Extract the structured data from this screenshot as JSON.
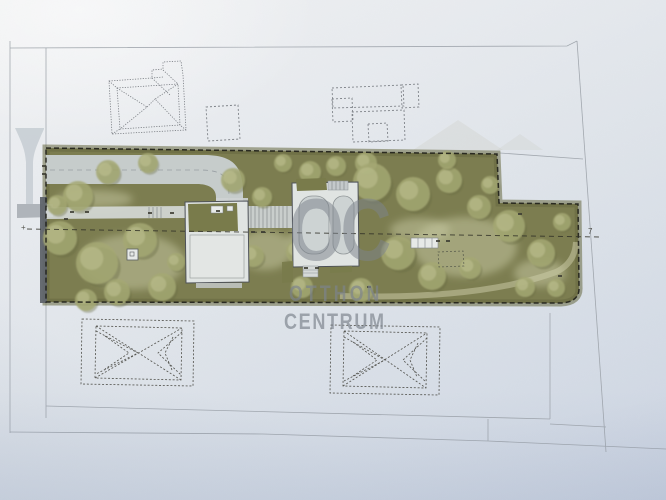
{
  "watermark": {
    "logo": "OC",
    "line1": "OTTHON",
    "line2": "CENTRUM"
  },
  "annotations": {
    "boundary_mark_right": "7",
    "boundary_mark_left": "+"
  },
  "palette": {
    "line_gray": "#9ba1a8",
    "ink": "#1f1f18",
    "site_green": "#7c7d50",
    "site_green_dark": "#66683f",
    "tree_light": "#a4a873",
    "tree_highlight": "#bcc08f",
    "lawn": "#c9cba5",
    "asphalt": "#ccd2d6",
    "roof_light": "#e0e4e2",
    "roof_green": "#797b4b",
    "watermark_gray": "#7d848d"
  },
  "site": {
    "trees": [
      [
        78,
        196,
        15
      ],
      [
        60,
        238,
        17
      ],
      [
        97,
        263,
        21
      ],
      [
        140,
        240,
        17
      ],
      [
        117,
        292,
        13
      ],
      [
        162,
        287,
        14
      ],
      [
        86,
        300,
        11
      ],
      [
        176,
        262,
        9
      ],
      [
        108,
        172,
        12
      ],
      [
        148,
        163,
        10
      ],
      [
        57,
        205,
        10
      ],
      [
        233,
        180,
        12
      ],
      [
        262,
        197,
        10
      ],
      [
        253,
        256,
        11
      ],
      [
        298,
        252,
        12
      ],
      [
        302,
        287,
        11
      ],
      [
        336,
        166,
        10
      ],
      [
        283,
        163,
        9
      ],
      [
        366,
        163,
        11
      ],
      [
        310,
        172,
        11
      ],
      [
        372,
        182,
        19
      ],
      [
        413,
        194,
        17
      ],
      [
        449,
        180,
        13
      ],
      [
        479,
        207,
        12
      ],
      [
        398,
        253,
        17
      ],
      [
        361,
        290,
        12
      ],
      [
        432,
        276,
        14
      ],
      [
        470,
        268,
        11
      ],
      [
        509,
        226,
        16
      ],
      [
        541,
        253,
        14
      ],
      [
        562,
        222,
        9
      ],
      [
        525,
        287,
        10
      ],
      [
        556,
        288,
        9
      ],
      [
        447,
        160,
        9
      ],
      [
        490,
        185,
        9
      ]
    ],
    "lawn_patches": [
      [
        133,
        262,
        52,
        28
      ],
      [
        265,
        250,
        28,
        20
      ],
      [
        310,
        240,
        22,
        14
      ],
      [
        465,
        247,
        52,
        30
      ],
      [
        540,
        273,
        26,
        14
      ],
      [
        95,
        199,
        38,
        9
      ],
      [
        210,
        255,
        18,
        22
      ],
      [
        420,
        230,
        30,
        12
      ]
    ],
    "ticks": [
      [
        72,
        212
      ],
      [
        87,
        212
      ],
      [
        150,
        213
      ],
      [
        172,
        213
      ],
      [
        218,
        211
      ],
      [
        253,
        232
      ],
      [
        263,
        232
      ],
      [
        306,
        268
      ],
      [
        317,
        268
      ],
      [
        369,
        287
      ],
      [
        438,
        241
      ],
      [
        448,
        241
      ],
      [
        520,
        214
      ],
      [
        66,
        219
      ],
      [
        560,
        276
      ],
      [
        44,
        166
      ],
      [
        44,
        174
      ]
    ]
  }
}
